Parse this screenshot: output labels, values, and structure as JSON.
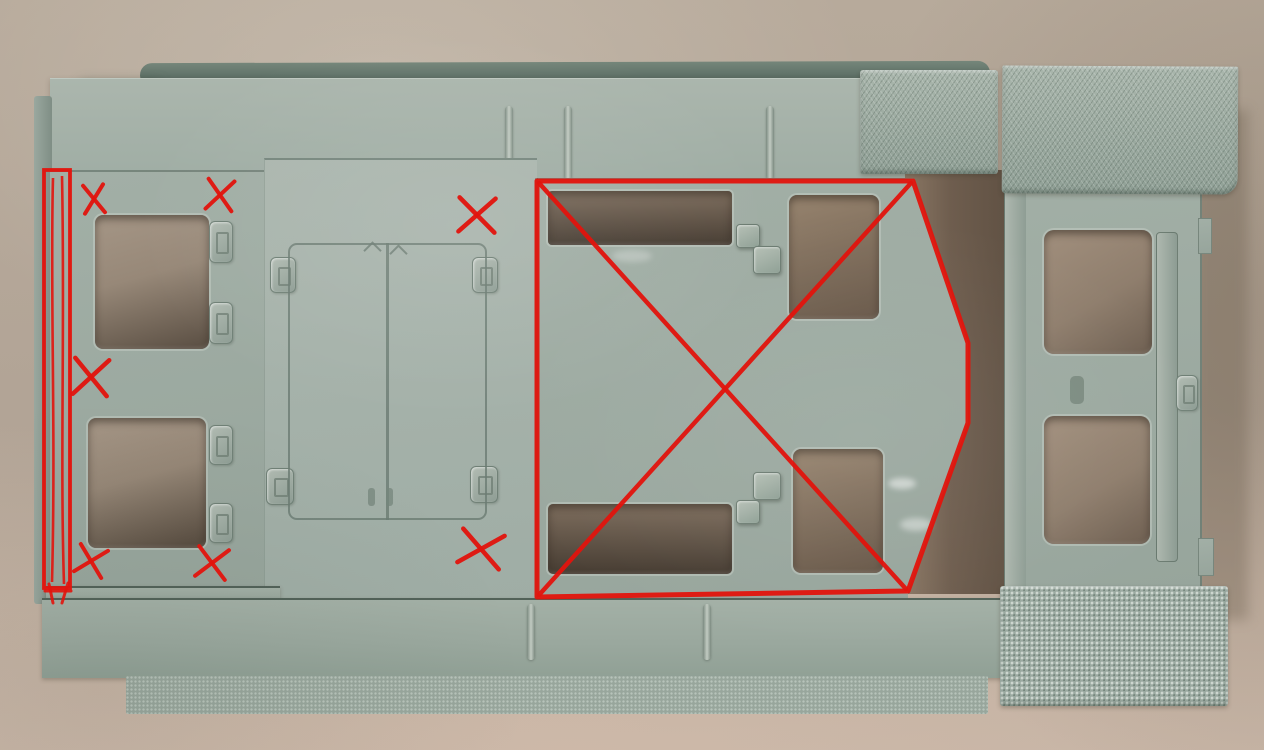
{
  "scene": {
    "description": "Photograph of a sage-green plastic model kit hull plate on a tan backdrop, annotated with red marker: seven small X marks, one tall outlined rectangle on the left, and one large crossed-out region in the center-right",
    "background_color": "#b4a798",
    "plastic_color": "#a1aea5",
    "hole_shadow_color": "#6e5d4e",
    "annotation_color": "#e2140d"
  },
  "annotations": {
    "color": "#e2140d",
    "x_marks": [
      {
        "cx": 94,
        "cy": 199,
        "rx": 10,
        "ry": 14,
        "rot": -4,
        "w": 4
      },
      {
        "cx": 220,
        "cy": 195,
        "rx": 13,
        "ry": 15,
        "rot": 6,
        "w": 4
      },
      {
        "cx": 477,
        "cy": 215,
        "rx": 18,
        "ry": 17,
        "rot": 2,
        "w": 4.5
      },
      {
        "cx": 91,
        "cy": 377,
        "rx": 17,
        "ry": 18,
        "rot": 4,
        "w": 4.5
      },
      {
        "cx": 91,
        "cy": 561,
        "rx": 14,
        "ry": 14,
        "rot": 14,
        "w": 4
      },
      {
        "cx": 212,
        "cy": 563,
        "rx": 15,
        "ry": 15,
        "rot": 8,
        "w": 4
      },
      {
        "cx": 481,
        "cy": 549,
        "rx": 21,
        "ry": 17,
        "rot": 10,
        "w": 4.5
      }
    ],
    "outlined_rect": {
      "x": 44,
      "y": 170,
      "w": 26,
      "h": 418,
      "stroke_width": 3.8,
      "inner_lines": [
        "M53,178 C50,290 56,430 52,582",
        "M62,176 C65,320 60,460 64,584"
      ],
      "extra_strokes": [
        [
          45,
          591,
          71,
          591
        ],
        [
          68,
          583,
          62,
          603
        ],
        [
          49,
          584,
          53,
          603
        ]
      ]
    },
    "crossed_region": {
      "stroke_width": 5,
      "points": [
        [
          537,
          181
        ],
        [
          913,
          181
        ],
        [
          968,
          343
        ],
        [
          968,
          423
        ],
        [
          908,
          591
        ],
        [
          537,
          597
        ]
      ],
      "diagonals": [
        [
          539,
          183,
          906,
          589
        ],
        [
          911,
          183,
          539,
          595
        ]
      ]
    }
  }
}
